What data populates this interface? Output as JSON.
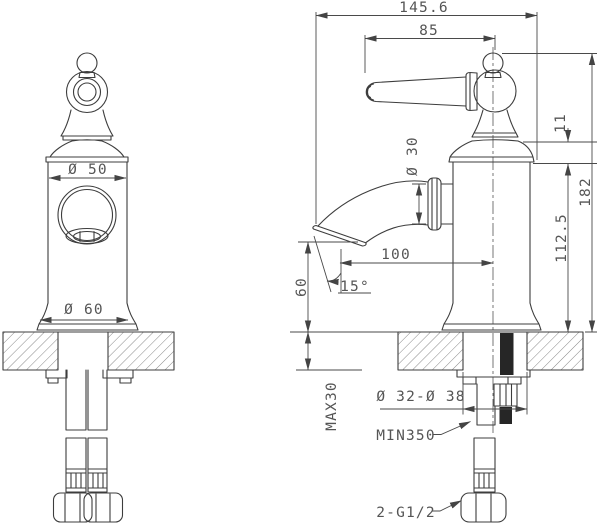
{
  "drawing": {
    "views": {
      "front": "front-view",
      "side": "side-view"
    }
  },
  "dimensions": {
    "overall_width": "145.6",
    "handle_length": "85",
    "handle_cap_height": "11",
    "total_height": "182",
    "body_height": "112.5",
    "spout_reach": "100",
    "spout_angle": "15°",
    "spout_outlet_height": "60",
    "body_diameter": "Ø 50",
    "spout_diameter": "Ø 30",
    "base_diameter": "Ø 60",
    "deck_thickness": "MAX30",
    "mounting_hole": "Ø 32-Ø 38",
    "hose_length": "MIN350",
    "supply_thread": "2-G1/2"
  }
}
